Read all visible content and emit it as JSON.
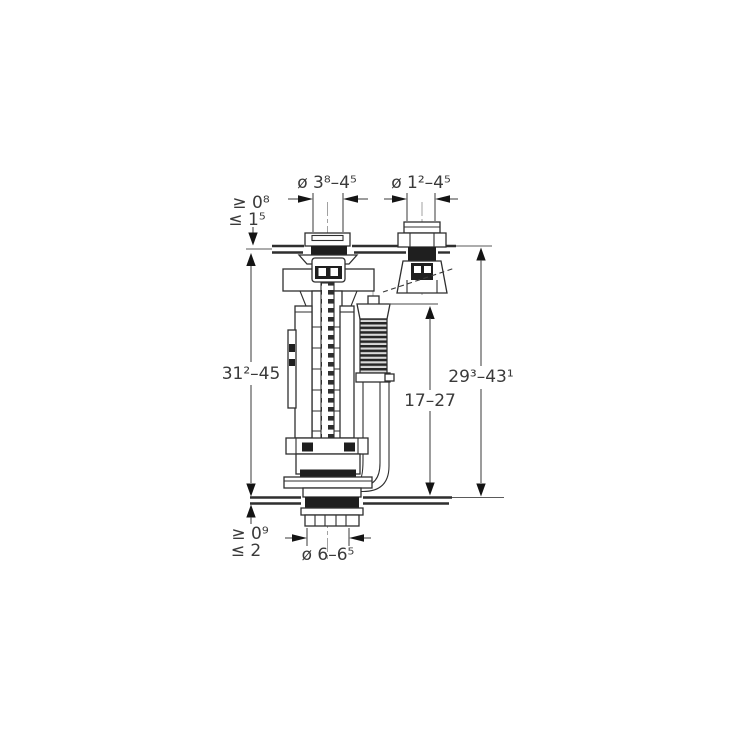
{
  "dimensions": {
    "flush_valve_lid_hole_diameter": "ø 3⁸–4⁵",
    "fill_valve_lid_hole_diameter": "ø 1²–4⁵",
    "lid_thickness_min": "≥ 0⁸",
    "lid_thickness_max": "≤ 1⁵",
    "flush_valve_height_range": "31²–45",
    "fill_valve_height_range": "29³–43¹",
    "fill_valve_body_height_range": "17–27",
    "tank_base_thickness_min": "≥ 0⁹",
    "tank_base_thickness_max": "≤ 2",
    "outlet_hole_diameter": "ø 6–6⁵"
  },
  "colors": {
    "background": "#ffffff",
    "line": "#2f2f2f",
    "dimension_text": "#3a3a3a",
    "dark_fill": "#1f1f1f"
  }
}
